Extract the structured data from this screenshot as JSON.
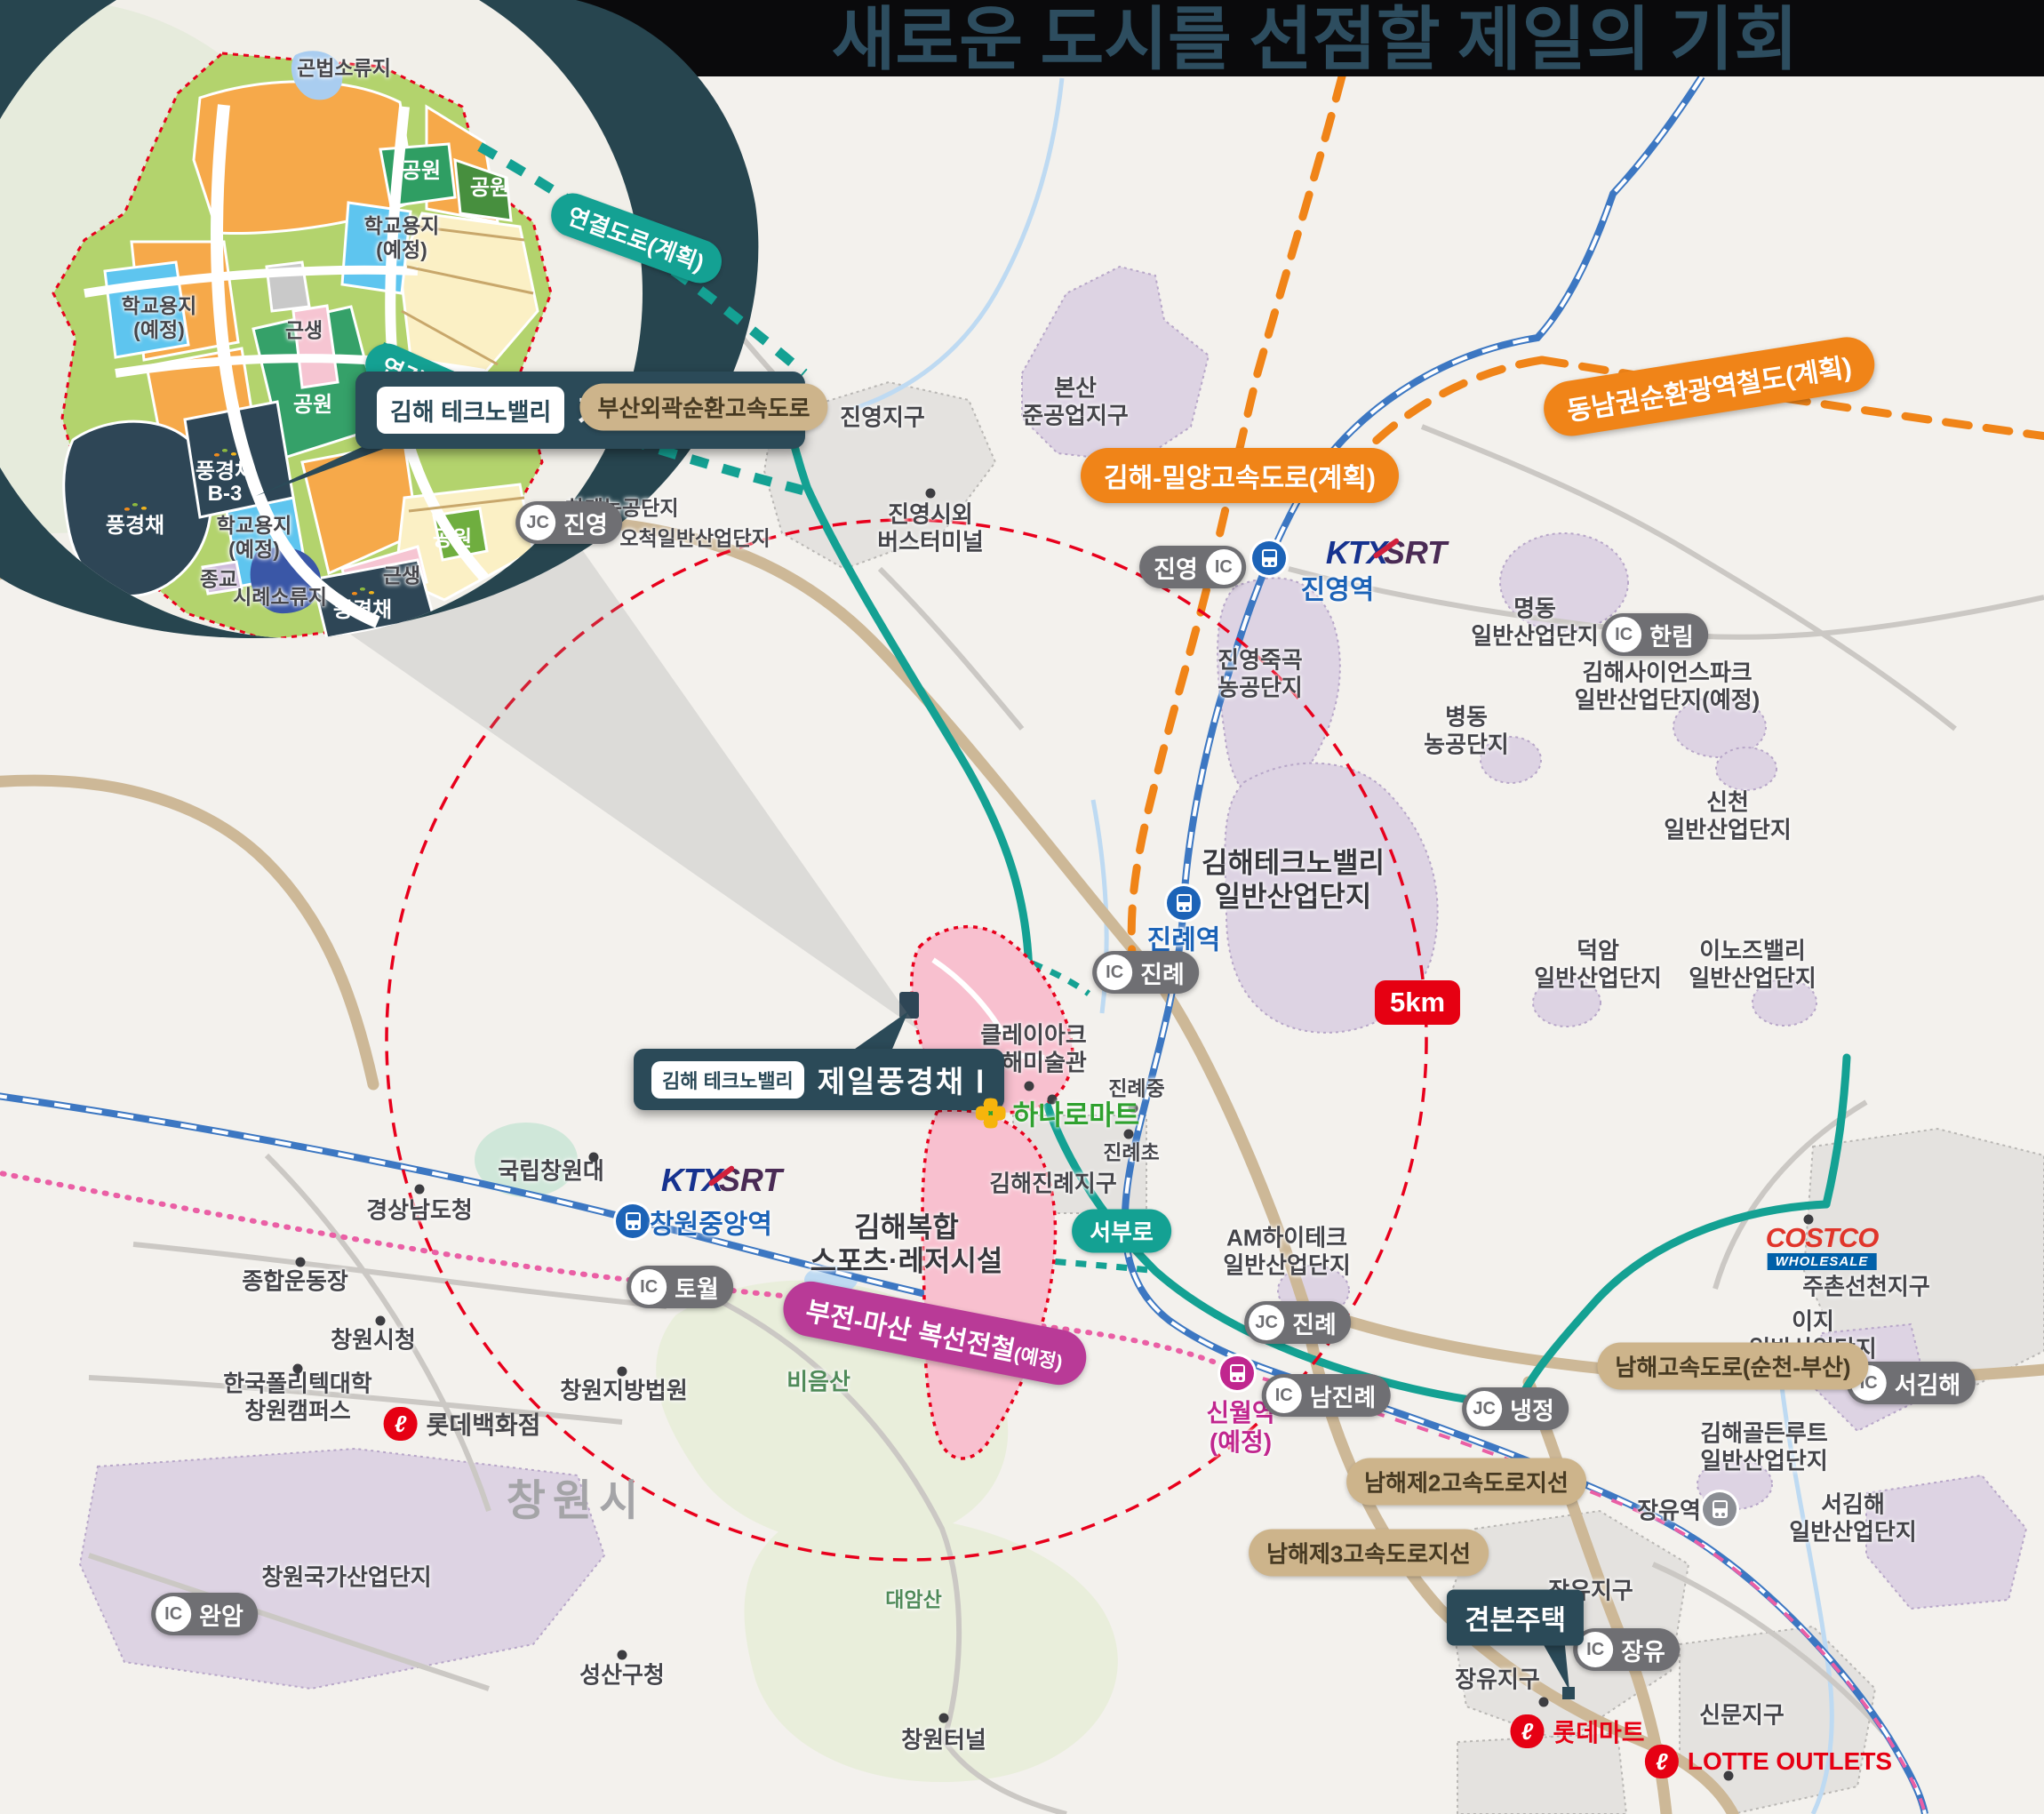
{
  "title": {
    "part1": "새로운 도시를 선점할 ",
    "part2": "제일의 기회"
  },
  "callout": {
    "badge": "김해 테크노밸리",
    "name": "제일풍경채 Ⅰ"
  },
  "badges": {
    "radius": "5km",
    "sample_house": "견본주택"
  },
  "logos": {
    "ktx": "KTX",
    "srt": "SRT",
    "costco": "COSTCO",
    "wholesale": "WHOLESALE",
    "lotte_glyph": "ℓ"
  },
  "inset": {
    "road_plan_label": "연결도로(계획)",
    "labels": [
      {
        "t": "곤법소류지"
      },
      {
        "t": "공원"
      },
      {
        "t": "공원"
      },
      {
        "t": "학교용지\n(예정)"
      },
      {
        "t": "학교용지\n(예정)"
      },
      {
        "t": "근생"
      },
      {
        "t": "공원"
      },
      {
        "t": "풍경채"
      },
      {
        "t": "B-3"
      },
      {
        "t": "풍경채"
      },
      {
        "t": "학교용지\n(예정)"
      },
      {
        "t": "종교"
      },
      {
        "t": "시례소류지"
      },
      {
        "t": "풍경채"
      },
      {
        "t": "공원"
      },
      {
        "t": "근생"
      }
    ]
  },
  "map": {
    "labels": [
      {
        "t": "진영지구"
      },
      {
        "t": "본산\n준공업지구"
      },
      {
        "t": "진영시외\n버스터미널"
      },
      {
        "t": "하계농공단지"
      },
      {
        "t": "오척일반산업단지"
      },
      {
        "t": "명동\n일반산업단지"
      },
      {
        "t": "진영죽곡\n농공단지"
      },
      {
        "t": "병동\n농공단지"
      },
      {
        "t": "김해사이언스파크\n일반산업단지(예정)"
      },
      {
        "t": "신천\n일반산업단지"
      },
      {
        "t": "김해테크노밸리\n일반산업단지"
      },
      {
        "t": "덕암\n일반산업단지"
      },
      {
        "t": "이노즈밸리\n일반산업단지"
      },
      {
        "t": "클레이아크\n김해미술관"
      },
      {
        "t": "진례중"
      },
      {
        "t": "진례초"
      },
      {
        "t": "김해진례지구"
      },
      {
        "t": "AM하이테크\n일반산업단지"
      },
      {
        "t": "김해복합\n스포츠·레저시설"
      },
      {
        "t": "비음산"
      },
      {
        "t": "대암산"
      },
      {
        "t": "국립창원대"
      },
      {
        "t": "경상남도청"
      },
      {
        "t": "종합운동장"
      },
      {
        "t": "창원시청"
      },
      {
        "t": "한국폴리텍대학\n창원캠퍼스"
      },
      {
        "t": "창원지방법원"
      },
      {
        "t": "창원시"
      },
      {
        "t": "창원국가산업단지"
      },
      {
        "t": "성산구청"
      },
      {
        "t": "창원터널"
      },
      {
        "t": "주촌선천지구"
      },
      {
        "t": "이지\n일반산업단지"
      },
      {
        "t": "김해골든루트\n일반산업단지"
      },
      {
        "t": "서김해\n일반산업단지"
      },
      {
        "t": "장유지구"
      },
      {
        "t": "장유지구"
      },
      {
        "t": "신문지구"
      }
    ],
    "stations": [
      {
        "n": "진영역"
      },
      {
        "n": "진례역"
      },
      {
        "n": "창원중앙역"
      },
      {
        "n": "신월역\n(예정)"
      },
      {
        "n": "장유역"
      }
    ],
    "ic": [
      {
        "k": "IC",
        "t": "한림"
      },
      {
        "k": "IC",
        "t": "진영"
      },
      {
        "k": "JC",
        "t": "진영"
      },
      {
        "k": "IC",
        "t": "진례"
      },
      {
        "k": "JC",
        "t": "진례"
      },
      {
        "k": "IC",
        "t": "남진례"
      },
      {
        "k": "JC",
        "t": "냉정"
      },
      {
        "k": "IC",
        "t": "서김해"
      },
      {
        "k": "IC",
        "t": "토월"
      },
      {
        "k": "IC",
        "t": "완암"
      },
      {
        "k": "IC",
        "t": "장유"
      }
    ],
    "road_pills": [
      {
        "t": "부산외곽순환고속도로"
      },
      {
        "t": "남해고속도로(순천-부산)"
      },
      {
        "t": "남해제2고속도로지선"
      },
      {
        "t": "남해제3고속도로지선"
      }
    ],
    "plan_pills": [
      {
        "t": "김해-밀양고속도로(계획)"
      },
      {
        "t": "동남권순환광역철도(계획)"
      },
      {
        "t": "부전-마산 복선전철",
        "t2": "(예정)"
      }
    ],
    "street_pill": "서부로",
    "retail": {
      "hanaro": "하나로마트",
      "lottemart": "롯데마트",
      "lottedept": "롯데백화점",
      "lotte_outlets": "LOTTE OUTLETS"
    }
  }
}
